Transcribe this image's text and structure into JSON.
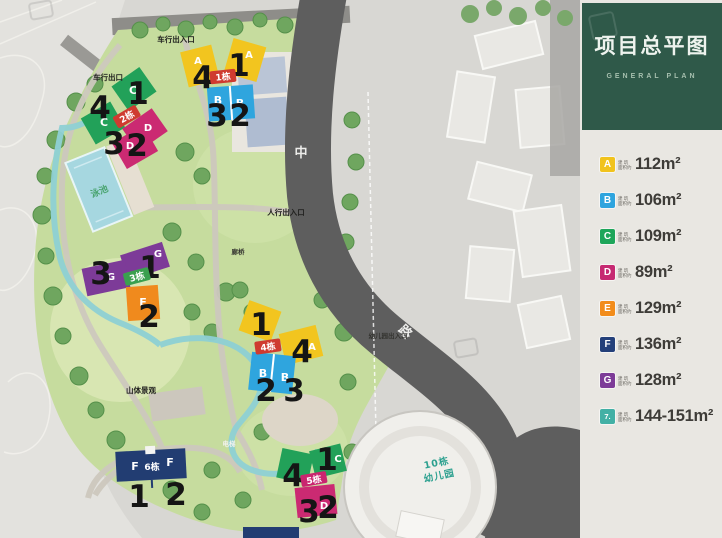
{
  "panel": {
    "title": "项目总平图",
    "subtitle": "GENERAL PLAN",
    "header_color": "#2f5949",
    "legend": [
      {
        "letter": "A",
        "color": "#f1c31d",
        "note1": "建 筑",
        "note2": "面积约",
        "area": "112m²"
      },
      {
        "letter": "B",
        "color": "#2ea4de",
        "note1": "建 筑",
        "note2": "面积约",
        "area": "106m²"
      },
      {
        "letter": "C",
        "color": "#1ea65a",
        "note1": "建 筑",
        "note2": "面积约",
        "area": "109m²"
      },
      {
        "letter": "D",
        "color": "#c62a72",
        "note1": "建 筑",
        "note2": "面积约",
        "area": "89m²"
      },
      {
        "letter": "E",
        "color": "#f28c1b",
        "note1": "建 筑",
        "note2": "面积约",
        "area": "129m²"
      },
      {
        "letter": "F",
        "color": "#24407a",
        "note1": "建 筑",
        "note2": "面积约",
        "area": "136m²"
      },
      {
        "letter": "G",
        "color": "#7d3b98",
        "note1": "建 筑",
        "note2": "面积约",
        "area": "128m²"
      },
      {
        "letter": "7.",
        "color": "#42b0a5",
        "note1": "建 筑",
        "note2": "面积约",
        "area": "144-151m²"
      }
    ]
  },
  "map": {
    "road_char_top": "中",
    "road_char_bottom": "路",
    "vehicle_entrance": "车行出入口",
    "vehicle_exit": "车行出口",
    "pedestrian_entrance": "人行出入口",
    "kindergarten_entrance": "幼儿园出入口",
    "mountain_landscape": "山体景观",
    "elevator": "电梯",
    "bridge": "廊桥",
    "pool": "泳池",
    "kindergarten_line1": "10栋",
    "kindergarten_line2": "幼儿园",
    "b1": {
      "tag": "1栋",
      "letters": [
        "A",
        "A",
        "B",
        "B"
      ],
      "nums": [
        "4",
        "1",
        "3",
        "2"
      ]
    },
    "b2": {
      "tag": "2栋",
      "letters": [
        "C",
        "C",
        "D",
        "D"
      ],
      "nums": [
        "1",
        "4",
        "3",
        "2"
      ]
    },
    "b3": {
      "tag": "3栋",
      "letters": [
        "G",
        "G",
        "E"
      ],
      "nums": [
        "1",
        "3",
        "2"
      ]
    },
    "b4": {
      "tag": "4栋",
      "letters": [
        "A",
        "B",
        "B"
      ],
      "nums": [
        "1",
        "4",
        "2",
        "3"
      ]
    },
    "b5": {
      "tag": "5栋",
      "letters": [
        "C",
        "D"
      ],
      "nums": [
        "4",
        "1",
        "3",
        "2"
      ]
    },
    "b6": {
      "tag": "6栋",
      "letters": [
        "F",
        "F"
      ],
      "nums": [
        "1",
        "2"
      ]
    }
  }
}
